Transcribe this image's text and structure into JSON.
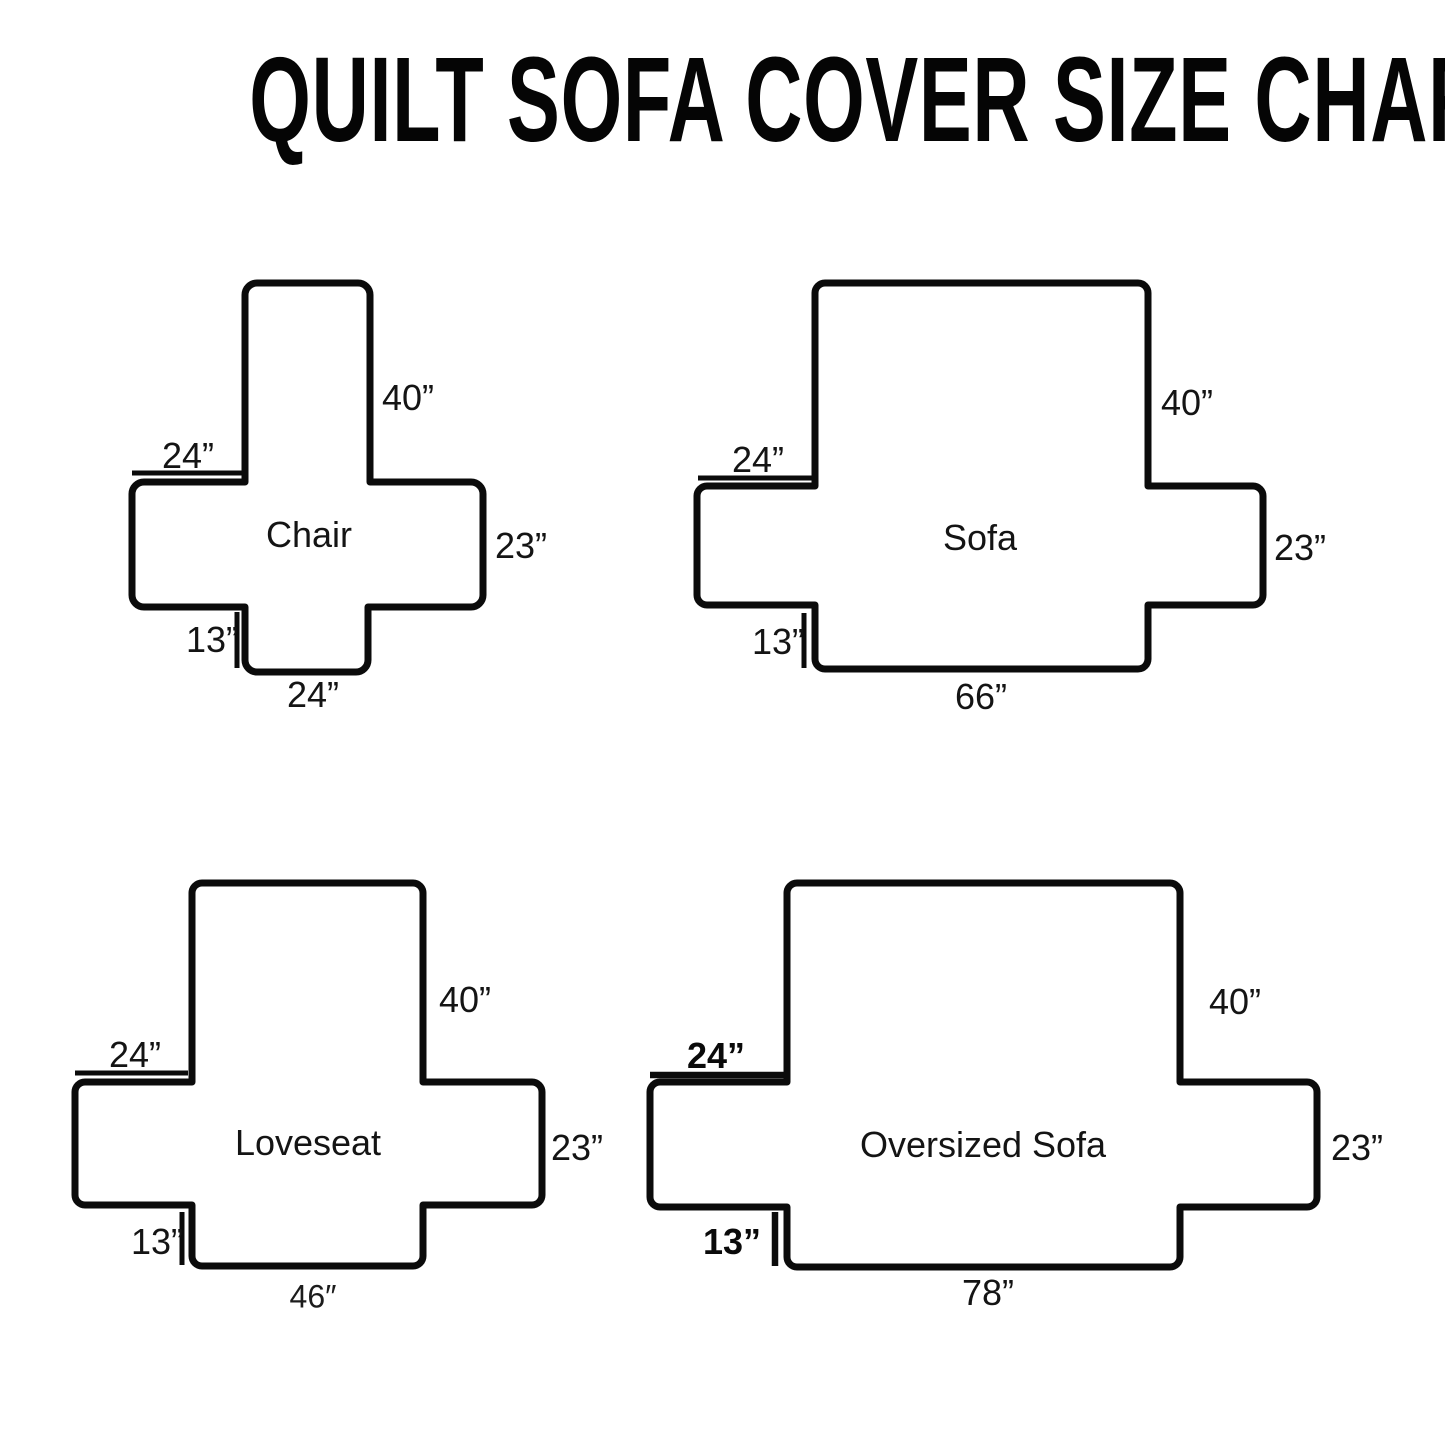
{
  "title": "QUILT SOFA COVER SIZE CHART",
  "diagrams": [
    {
      "name": "Chair",
      "back_height": "40”",
      "arm_top_width": "24”",
      "arm_side_height": "23”",
      "front_drop": "13”",
      "seat_front_width": "24”"
    },
    {
      "name": "Sofa",
      "back_height": "40”",
      "arm_top_width": "24”",
      "arm_side_height": "23”",
      "front_drop": "13”",
      "seat_front_width": "66”"
    },
    {
      "name": "Loveseat",
      "back_height": "40”",
      "arm_top_width": "24”",
      "arm_side_height": "23”",
      "front_drop": "13”",
      "seat_front_width": "46″"
    },
    {
      "name": "Oversized Sofa",
      "back_height": "40”",
      "arm_top_width": "24”",
      "arm_side_height": "23”",
      "front_drop": "13”",
      "seat_front_width": "78”"
    }
  ]
}
